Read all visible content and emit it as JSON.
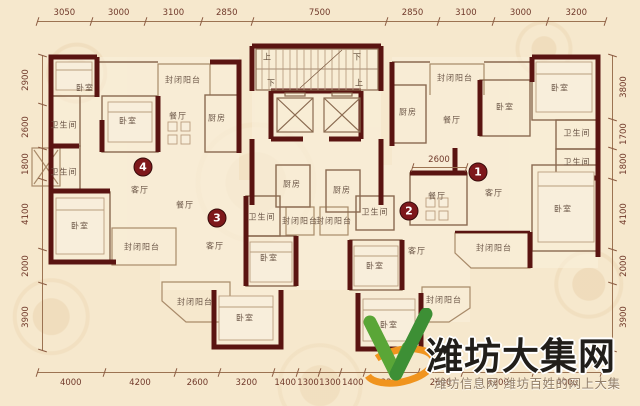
{
  "colors": {
    "bg": "#f6e8cd",
    "wall": "#5a1411",
    "badge": "#7e181b",
    "dim_text": "#70392a",
    "room_text": "#6b5647",
    "wm_title": "#211e1a",
    "wm_sub": "#927e68",
    "logo_green": "#5aa637",
    "logo_green_dark": "#3d8f35",
    "logo_orange": "#f0941e"
  },
  "dimensions": {
    "top": [
      "3050",
      "3000",
      "3100",
      "2850",
      "7500",
      "2850",
      "3100",
      "3000",
      "3200"
    ],
    "bottom": [
      "4000",
      "4200",
      "2600",
      "3200",
      "1400",
      "1300",
      "1300",
      "1400",
      "3200",
      "2600",
      "4200",
      "4000"
    ],
    "left": [
      "2900",
      "2600",
      "1800",
      "4100",
      "2000",
      "3900"
    ],
    "right": [
      "3800",
      "1700",
      "1800",
      "4100",
      "2000",
      "3900"
    ],
    "internal": [
      {
        "label": "2600",
        "x1": 412,
        "x2": 466,
        "y": 167
      }
    ]
  },
  "unit_badges": [
    {
      "number": "1",
      "x": 478,
      "y": 172
    },
    {
      "number": "2",
      "x": 409,
      "y": 211
    },
    {
      "number": "3",
      "x": 217,
      "y": 218
    },
    {
      "number": "4",
      "x": 143,
      "y": 167
    }
  ],
  "rooms": [
    {
      "label": "卧室",
      "x": 85,
      "y": 88
    },
    {
      "label": "卫生间",
      "x": 64,
      "y": 125
    },
    {
      "label": "卫生间",
      "x": 64,
      "y": 172
    },
    {
      "label": "卧室",
      "x": 128,
      "y": 121
    },
    {
      "label": "封闭阳台",
      "x": 183,
      "y": 80
    },
    {
      "label": "餐厅",
      "x": 178,
      "y": 116
    },
    {
      "label": "厨房",
      "x": 217,
      "y": 118
    },
    {
      "label": "客厅",
      "x": 140,
      "y": 190
    },
    {
      "label": "卧室",
      "x": 80,
      "y": 226
    },
    {
      "label": "封闭阳台",
      "x": 142,
      "y": 247
    },
    {
      "label": "餐厅",
      "x": 185,
      "y": 205
    },
    {
      "label": "客厅",
      "x": 215,
      "y": 246
    },
    {
      "label": "卫生间",
      "x": 262,
      "y": 217
    },
    {
      "label": "卧室",
      "x": 269,
      "y": 258
    },
    {
      "label": "封闭阳台",
      "x": 195,
      "y": 302
    },
    {
      "label": "卧室",
      "x": 245,
      "y": 318
    },
    {
      "label": "厨房",
      "x": 292,
      "y": 184
    },
    {
      "label": "厨房",
      "x": 342,
      "y": 190
    },
    {
      "label": "封闭阳台",
      "x": 300,
      "y": 221
    },
    {
      "label": "封闭阳台",
      "x": 334,
      "y": 221
    },
    {
      "label": "卫生间",
      "x": 375,
      "y": 212
    },
    {
      "label": "客厅",
      "x": 417,
      "y": 251
    },
    {
      "label": "卧室",
      "x": 375,
      "y": 266
    },
    {
      "label": "卧室",
      "x": 389,
      "y": 325
    },
    {
      "label": "封闭阳台",
      "x": 444,
      "y": 300
    },
    {
      "label": "厨房",
      "x": 408,
      "y": 112
    },
    {
      "label": "封闭阳台",
      "x": 455,
      "y": 78
    },
    {
      "label": "餐厅",
      "x": 452,
      "y": 120
    },
    {
      "label": "卧室",
      "x": 505,
      "y": 107
    },
    {
      "label": "卧室",
      "x": 560,
      "y": 88
    },
    {
      "label": "卫生间",
      "x": 577,
      "y": 133
    },
    {
      "label": "卫生间",
      "x": 577,
      "y": 162
    },
    {
      "label": "餐厅",
      "x": 437,
      "y": 196
    },
    {
      "label": "客厅",
      "x": 494,
      "y": 193
    },
    {
      "label": "卧室",
      "x": 563,
      "y": 209
    },
    {
      "label": "封闭阳台",
      "x": 494,
      "y": 248
    }
  ],
  "stair_labels": [
    {
      "label": "上",
      "x": 267,
      "y": 57
    },
    {
      "label": "下",
      "x": 357,
      "y": 57
    },
    {
      "label": "下",
      "x": 271,
      "y": 83
    },
    {
      "label": "上",
      "x": 359,
      "y": 83
    }
  ],
  "watermark": {
    "title": "潍坊大集网",
    "subtitle": "潍坊信息网 潍坊百姓的网上大集"
  }
}
